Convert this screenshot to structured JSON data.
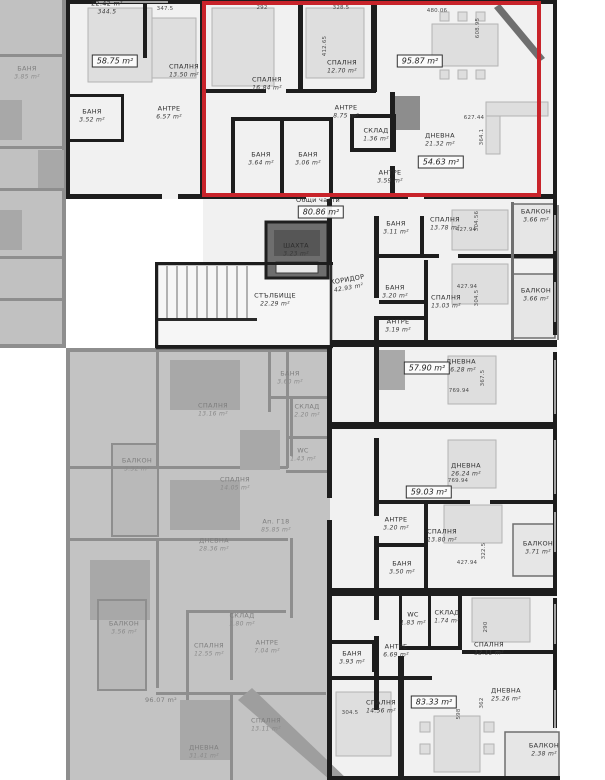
{
  "plan": {
    "type": "architectural-floor-plan",
    "language": "bg",
    "units": "m²",
    "highlight": {
      "x": 202,
      "y": 1,
      "w": 339,
      "h": 196,
      "color": "#c8232a"
    },
    "rooms": [
      {
        "n": "22.42 m²",
        "a": "344.5",
        "x": 107,
        "y": 8
      },
      {
        "n": "СПАЛНЯ",
        "a": "13.50 m²",
        "x": 184,
        "y": 71
      },
      {
        "n": "АНТРЕ",
        "a": "6.57 m²",
        "x": 169,
        "y": 113
      },
      {
        "n": "БАНЯ",
        "a": "3.52 m²",
        "x": 92,
        "y": 116
      },
      {
        "n": "СПАЛНЯ",
        "a": "16.84 m²",
        "x": 267,
        "y": 84
      },
      {
        "n": "СПАЛНЯ",
        "a": "12.70 m²",
        "x": 342,
        "y": 67
      },
      {
        "n": "АНТРЕ",
        "a": "8.75 m²",
        "x": 346,
        "y": 112
      },
      {
        "n": "БАНЯ",
        "a": "3.64 m²",
        "x": 261,
        "y": 159
      },
      {
        "n": "БАНЯ",
        "a": "3.06 m²",
        "x": 308,
        "y": 159
      },
      {
        "n": "СКЛАД",
        "a": "1.36 m²",
        "x": 376,
        "y": 135
      },
      {
        "n": "АНТРЕ",
        "a": "3.59 m²",
        "x": 390,
        "y": 177
      },
      {
        "n": "ДНЕВНА",
        "a": "21.32 m²",
        "x": 440,
        "y": 140
      },
      {
        "n": "Общи части",
        "a": "",
        "x": 318,
        "y": 201
      },
      {
        "n": "ШАХТА",
        "a": "3.23 m²",
        "x": 296,
        "y": 250
      },
      {
        "n": "СТЪЛБИЩЕ",
        "a": "22.29 m²",
        "x": 275,
        "y": 300
      },
      {
        "n": "КОРИДОР",
        "a": "42.93 m²",
        "x": 348,
        "y": 284,
        "rot": -10
      },
      {
        "n": "БАНЯ",
        "a": "3.11 m²",
        "x": 396,
        "y": 228
      },
      {
        "n": "СПАЛНЯ",
        "a": "13.78 m²",
        "x": 445,
        "y": 224
      },
      {
        "n": "БАЛКОН",
        "a": "3.66 m²",
        "x": 536,
        "y": 216
      },
      {
        "n": "БАНЯ",
        "a": "3.20 m²",
        "x": 395,
        "y": 292
      },
      {
        "n": "СПАЛНЯ",
        "a": "13.03 m²",
        "x": 446,
        "y": 302
      },
      {
        "n": "БАЛКОН",
        "a": "3.66 m²",
        "x": 536,
        "y": 295
      },
      {
        "n": "АНТРЕ",
        "a": "3.19 m²",
        "x": 398,
        "y": 326
      },
      {
        "n": "ДНЕВНА",
        "a": "26.28 m²",
        "x": 461,
        "y": 366
      },
      {
        "n": "ДНЕВНА",
        "a": "26.24 m²",
        "x": 466,
        "y": 470
      },
      {
        "n": "АНТРЕ",
        "a": "3.20 m²",
        "x": 396,
        "y": 524
      },
      {
        "n": "СПАЛНЯ",
        "a": "13.80 m²",
        "x": 442,
        "y": 536
      },
      {
        "n": "БАЛКОН",
        "a": "3.71 m²",
        "x": 538,
        "y": 548
      },
      {
        "n": "БАНЯ",
        "a": "3.50 m²",
        "x": 402,
        "y": 568
      },
      {
        "n": "WC",
        "a": "1.83 m²",
        "x": 413,
        "y": 619
      },
      {
        "n": "СКЛАД",
        "a": "1.74 m²",
        "x": 447,
        "y": 617
      },
      {
        "n": "СПАЛНЯ",
        "a": "12.11 m²",
        "x": 489,
        "y": 649
      },
      {
        "n": "АНТРЕ",
        "a": "6.69 m²",
        "x": 396,
        "y": 651
      },
      {
        "n": "БАНЯ",
        "a": "3.93 m²",
        "x": 352,
        "y": 658
      },
      {
        "n": "СПАЛНЯ",
        "a": "14.56 m²",
        "x": 381,
        "y": 707
      },
      {
        "n": "ДНЕВНА",
        "a": "25.26 m²",
        "x": 506,
        "y": 695
      },
      {
        "n": "БАЛКОН",
        "a": "2.38 m²",
        "x": 544,
        "y": 750
      },
      {
        "n": "БАНЯ",
        "a": "3.85 m²",
        "x": 27,
        "y": 73,
        "f": true
      },
      {
        "n": "СПАЛНЯ",
        "a": "13.16 m²",
        "x": 213,
        "y": 410,
        "f": true
      },
      {
        "n": "БАНЯ",
        "a": "3.60 m²",
        "x": 290,
        "y": 378,
        "f": true
      },
      {
        "n": "СКЛАД",
        "a": "2.20 m²",
        "x": 307,
        "y": 411,
        "f": true
      },
      {
        "n": "WC",
        "a": "1.43 m²",
        "x": 303,
        "y": 455,
        "f": true
      },
      {
        "n": "СПАЛНЯ",
        "a": "14.05 m²",
        "x": 235,
        "y": 484,
        "f": true
      },
      {
        "n": "Ап. Г18",
        "a": "85.85 m²",
        "x": 276,
        "y": 526,
        "f": true
      },
      {
        "n": "ДНЕВНА",
        "a": "28.36 m²",
        "x": 214,
        "y": 545,
        "f": true
      },
      {
        "n": "БАЛКОН",
        "a": "3.32 m²",
        "x": 137,
        "y": 465,
        "f": true
      },
      {
        "n": "БАЛКОН",
        "a": "3.56 m²",
        "x": 124,
        "y": 628,
        "f": true
      },
      {
        "n": "96.07 m²",
        "a": "",
        "x": 161,
        "y": 701,
        "f": true
      },
      {
        "n": "СПАЛНЯ",
        "a": "12.55 m²",
        "x": 209,
        "y": 650,
        "f": true
      },
      {
        "n": "СКЛАД",
        "a": "1.80 m²",
        "x": 242,
        "y": 620,
        "f": true
      },
      {
        "n": "АНТРЕ",
        "a": "7.04 m²",
        "x": 267,
        "y": 647,
        "f": true
      },
      {
        "n": "СПАЛНЯ",
        "a": "13.11 m²",
        "x": 266,
        "y": 725,
        "f": true
      },
      {
        "n": "ДНЕВНА",
        "a": "31.41 m²",
        "x": 204,
        "y": 752,
        "f": true
      }
    ],
    "area_boxes": [
      {
        "t": "58.75 m²",
        "x": 115,
        "y": 61
      },
      {
        "t": "95.87 m²",
        "x": 420,
        "y": 61
      },
      {
        "t": "54.63 m²",
        "x": 441,
        "y": 162
      },
      {
        "t": "80.86 m²",
        "x": 321,
        "y": 212
      },
      {
        "t": "57.90 m²",
        "x": 427,
        "y": 368
      },
      {
        "t": "59.03 m²",
        "x": 429,
        "y": 492
      },
      {
        "t": "83.33 m²",
        "x": 434,
        "y": 702
      }
    ],
    "dimensions": [
      {
        "t": "347.5",
        "x": 165,
        "y": 9
      },
      {
        "t": "292",
        "x": 262,
        "y": 8
      },
      {
        "t": "328.5",
        "x": 341,
        "y": 8
      },
      {
        "t": "412.65",
        "x": 325,
        "y": 46,
        "v": true
      },
      {
        "t": "480.06",
        "x": 437,
        "y": 11
      },
      {
        "t": "608.95",
        "x": 478,
        "y": 28,
        "v": true
      },
      {
        "t": "627.44",
        "x": 474,
        "y": 118
      },
      {
        "t": "364.1",
        "x": 482,
        "y": 137,
        "v": true
      },
      {
        "t": "304.56",
        "x": 477,
        "y": 221,
        "v": true
      },
      {
        "t": "427.94",
        "x": 466,
        "y": 230
      },
      {
        "t": "427.94",
        "x": 467,
        "y": 287
      },
      {
        "t": "304.5",
        "x": 477,
        "y": 298,
        "v": true
      },
      {
        "t": "367.5",
        "x": 483,
        "y": 378,
        "v": true
      },
      {
        "t": "769.94",
        "x": 459,
        "y": 391
      },
      {
        "t": "769.94",
        "x": 458,
        "y": 481
      },
      {
        "t": "322.5",
        "x": 484,
        "y": 551,
        "v": true
      },
      {
        "t": "427.94",
        "x": 467,
        "y": 563
      },
      {
        "t": "290",
        "x": 486,
        "y": 627,
        "v": true
      },
      {
        "t": "304.5",
        "x": 350,
        "y": 713
      },
      {
        "t": "598",
        "x": 459,
        "y": 714,
        "v": true
      },
      {
        "t": "362",
        "x": 482,
        "y": 703,
        "v": true
      }
    ]
  }
}
